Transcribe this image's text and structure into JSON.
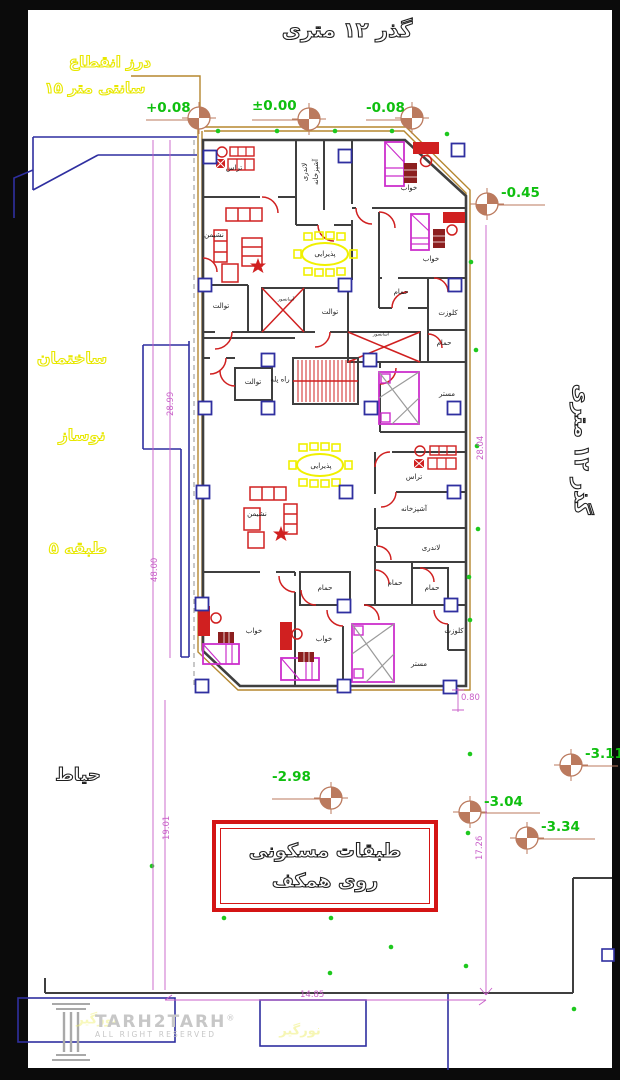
{
  "titles": {
    "road_top": "گذر ۱۲ متری",
    "road_right": "گذر ۱۲ متری",
    "expansion_joint_line1": "درز انقطاع",
    "expansion_joint_line2": "۱۵ سانتی متر",
    "neighbor_line1": "ساختمان",
    "neighbor_line2": "نوساز",
    "neighbor_line3": "۵ طبقه",
    "yard": "حیاط",
    "note_line1": "طبقات مسکونی",
    "note_line2": "روی همکف",
    "lightwell_left": "نورگیر",
    "lightwell_center": "نورگیر"
  },
  "rooms": [
    {
      "label": "تراس"
    },
    {
      "label": "لاندری"
    },
    {
      "label": "آشپزخانه"
    },
    {
      "label": "خواب"
    },
    {
      "label": "نشیمن"
    },
    {
      "label": "پذیرایی"
    },
    {
      "label": "توالت"
    },
    {
      "label": "توالت"
    },
    {
      "label": "حمام"
    },
    {
      "label": "کلوزت"
    },
    {
      "label": "حمام"
    },
    {
      "label": "خواب"
    },
    {
      "label": "آسانسور"
    },
    {
      "label": "آسانسور"
    },
    {
      "label": "راه پله"
    },
    {
      "label": "توالت"
    },
    {
      "label": "مستر"
    },
    {
      "label": "پذیرایی"
    },
    {
      "label": "نشیمن"
    },
    {
      "label": "تراس"
    },
    {
      "label": "آشپزخانه"
    },
    {
      "label": "لاندری"
    },
    {
      "label": "حمام"
    },
    {
      "label": "حمام"
    },
    {
      "label": "حمام"
    },
    {
      "label": "خواب"
    },
    {
      "label": "خواب"
    },
    {
      "label": "کلوزت"
    },
    {
      "label": "مستر"
    }
  ],
  "elevations": [
    {
      "label": "+0.08"
    },
    {
      "label": "±0.00"
    },
    {
      "label": "-0.08"
    },
    {
      "label": "-0.45"
    },
    {
      "label": "-2.98"
    },
    {
      "label": "-3.11"
    },
    {
      "label": "-3.04"
    },
    {
      "label": "-3.34"
    }
  ],
  "dims": [
    {
      "value": "28.99"
    },
    {
      "value": "48.00"
    },
    {
      "value": "19.01"
    },
    {
      "value": "28.04"
    },
    {
      "value": "17.26"
    },
    {
      "value": "0.80"
    },
    {
      "value": "14.85"
    }
  ],
  "watermark": {
    "brand": "TARH2TARH",
    "registered": "®",
    "tagline": "ALL RIGHT RESERVED"
  },
  "colors": {
    "wall": "#3f3f3f",
    "boundary_tan": "#b5872f",
    "neighbor_navy": "#2f2fa0",
    "door_red": "#d02020",
    "furniture_magenta": "#cc2fcc",
    "dining_yellow": "#f0f000",
    "elevation_green": "#0fbf0f",
    "dimension_magenta": "#c85fc8",
    "marker_salmon": "#bb7a5e",
    "note_border_red": "#d41414"
  }
}
